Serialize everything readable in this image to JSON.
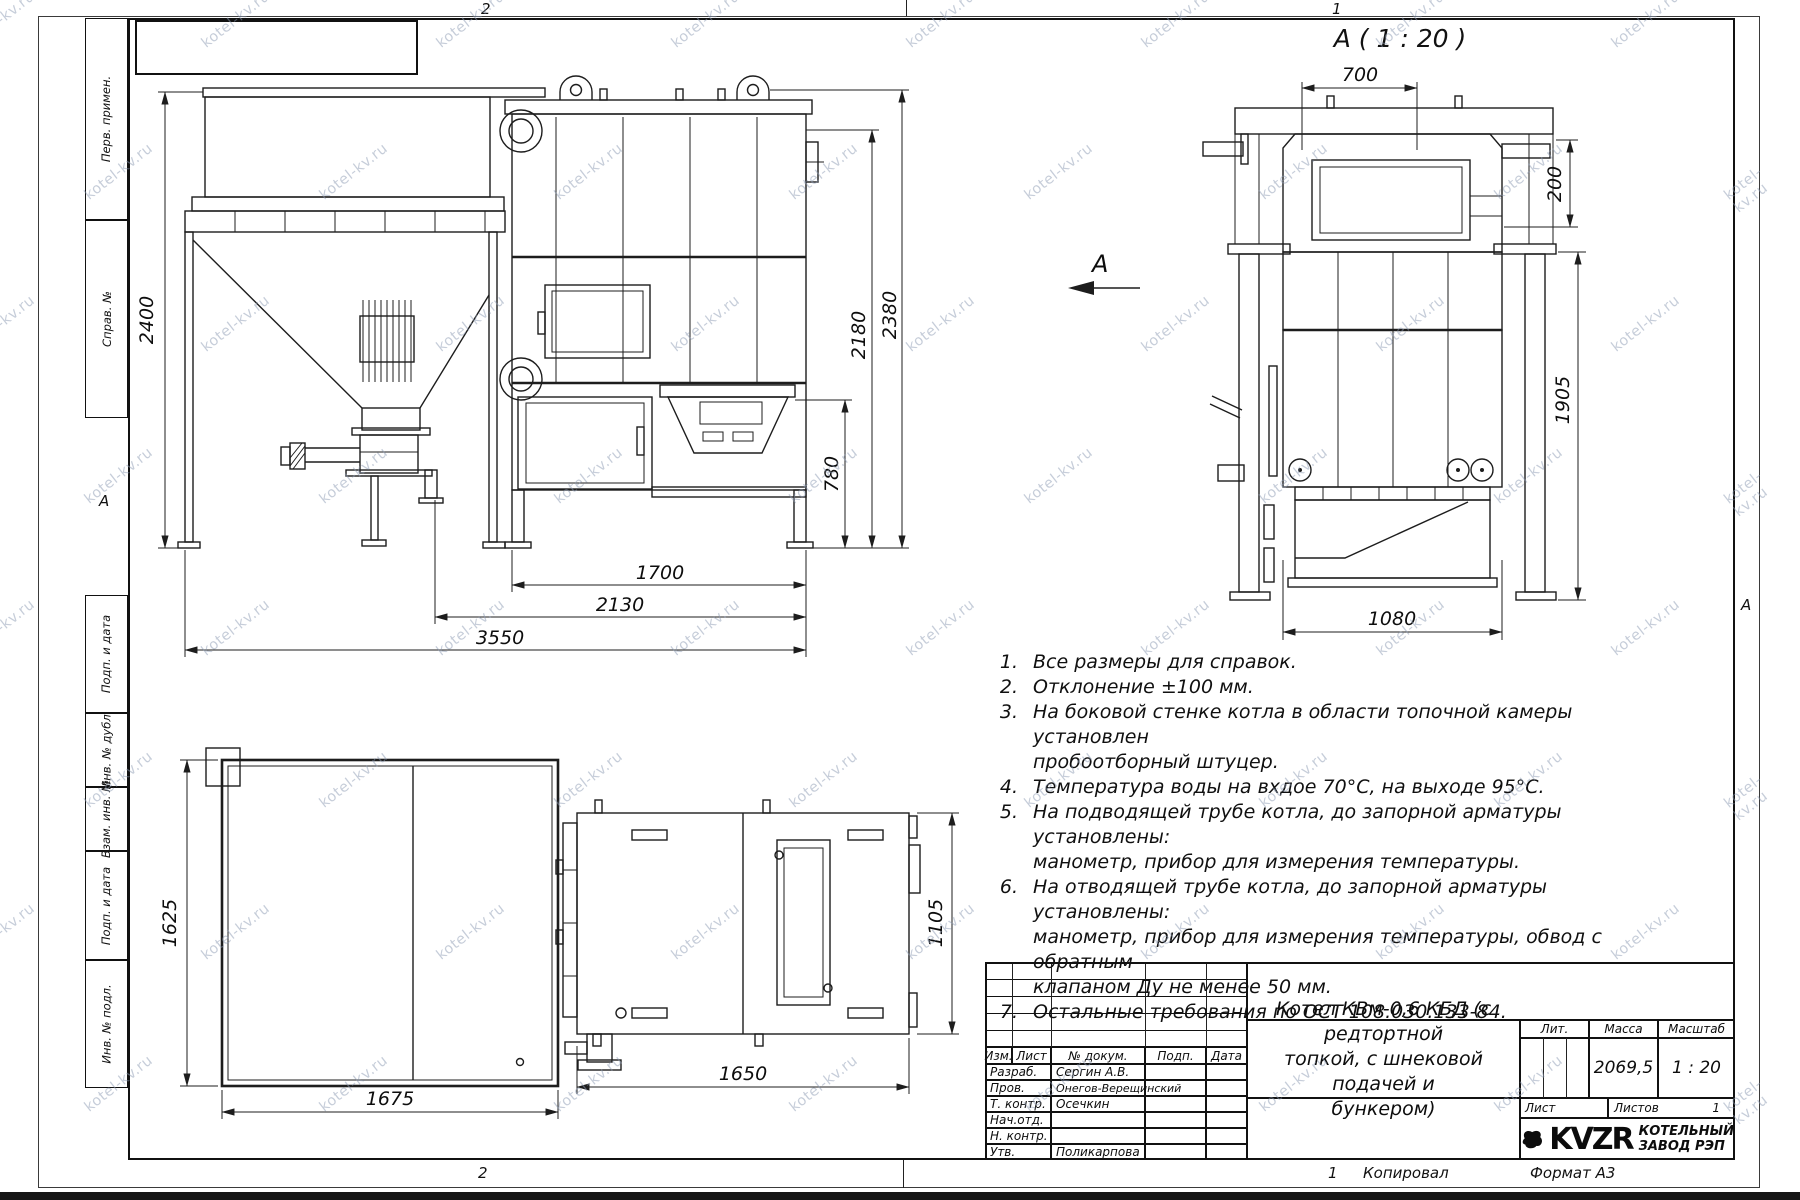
{
  "watermark": {
    "text": "kotel-kv.ru"
  },
  "frame": {
    "zone_top_left": "2",
    "zone_top_right": "1",
    "zone_bottom_left": "2",
    "zone_bottom_right": "1",
    "fold_marker_left": "А",
    "fold_marker_right": "А",
    "copied": "Копировал",
    "format": "Формат А3"
  },
  "sidebar": {
    "top": [
      {
        "label": "Перв. примен."
      },
      {
        "label": "Справ. №"
      }
    ],
    "bottom": [
      {
        "label": "Подп. и дата"
      },
      {
        "label": "Инв. № дубл."
      },
      {
        "label": "Взам. инв. №"
      },
      {
        "label": "Подп. и дата"
      },
      {
        "label": "Инв. № подл."
      }
    ]
  },
  "detail_view": {
    "label": "А ( 1 : 20 )",
    "arrow_label": "А"
  },
  "dims": {
    "front": {
      "h2400": "2400",
      "h2380": "2380",
      "h2180": "2180",
      "h780": "780",
      "w1700": "1700",
      "w2130": "2130",
      "w3550": "3550"
    },
    "rear": {
      "w700": "700",
      "h200": "200",
      "h1905": "1905",
      "w1080": "1080"
    },
    "plan": {
      "h1625": "1625",
      "w1675": "1675"
    },
    "top": {
      "w1650": "1650",
      "h1105": "1105"
    }
  },
  "notes": [
    {
      "num": "1.",
      "text": "Все размеры для справок."
    },
    {
      "num": "2.",
      "text": "Отклонение ±100 мм."
    },
    {
      "num": "3.",
      "text": "На боковой стенке котла в области топочной камеры установлен\nпробоотборный штуцер."
    },
    {
      "num": "4.",
      "text": "Температура воды на вхдое 70°С, на выходе 95°С."
    },
    {
      "num": "5.",
      "text": "На подводящей трубе котла, до запорной арматуры установлены:\nманометр, прибор для измерения температуры."
    },
    {
      "num": "6.",
      "text": "На отводящей трубе котла, до запорной арматуры установлены:\nманометр, прибор для измерения температуры, обвод с обратным\nклапаном Ду не менее 50 мм."
    },
    {
      "num": "7.",
      "text": "Остальные требования по ОСТ 108.030.133-84."
    }
  ],
  "title_block": {
    "rev_header": [
      "Изм.",
      "Лист",
      "№ докум.",
      "Подп.",
      "Дата"
    ],
    "signature_rows": [
      {
        "role": "Разраб.",
        "name": "Сергин А.В."
      },
      {
        "role": "Пров.",
        "name": "Онегов-Верещинский"
      },
      {
        "role": "Т. контр.",
        "name": "Осечкин"
      },
      {
        "role": "Нач.отд.",
        "name": ""
      },
      {
        "role": "Н. контр.",
        "name": ""
      },
      {
        "role": "Утв.",
        "name": "Поликарпова"
      }
    ],
    "doc_title": "Котел КВм-0,6 КБД (с редтортной\nтопкой, с шнековой подачей и\nбункером)",
    "lit_label": "Лит.",
    "mass_label": "Масса",
    "scale_label": "Масштаб",
    "mass_value": "2069,5",
    "scale_value": "1 : 20",
    "sheet_label": "Лист",
    "sheets_label": "Листов",
    "sheets_value": "1",
    "logo_text": "KVZR",
    "company_line1": "КОТЕЛЬНЫЙ",
    "company_line2": "ЗАВОД РЭП"
  }
}
